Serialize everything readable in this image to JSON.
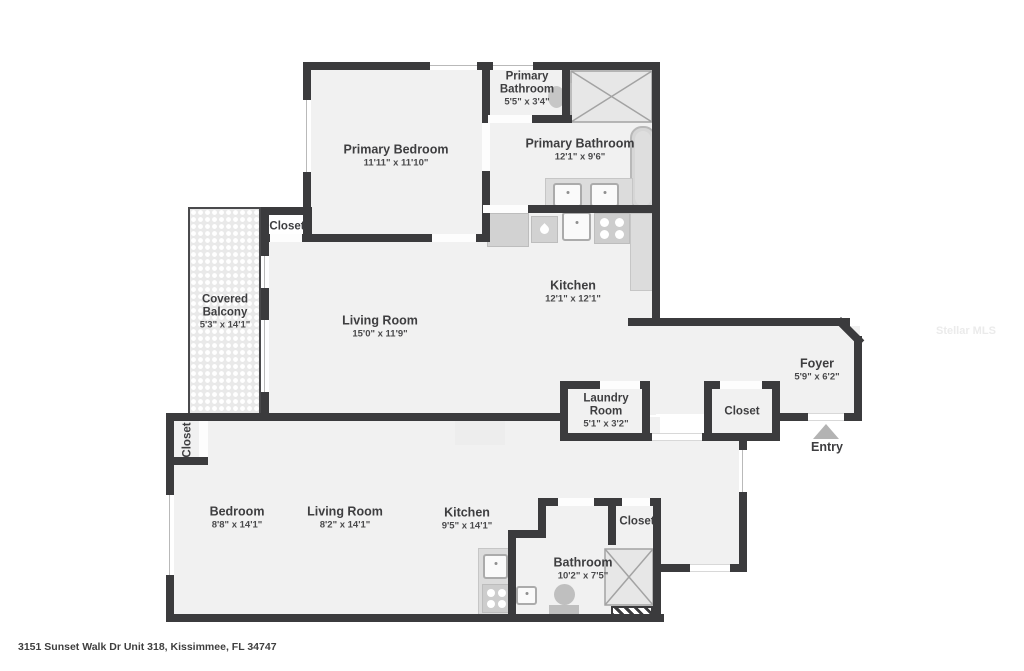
{
  "meta": {
    "address": "3151 Sunset Walk Dr Unit 318, Kissimmee, FL 34747",
    "watermark": "Stellar MLS"
  },
  "colors": {
    "wall": "#3b3b3d",
    "floor": "#f1f1f1",
    "fixture": "#d2d2d2",
    "balcony_tile": "#e9e9e9",
    "entry_arrow": "#b3b3b3",
    "text": "#3e3e40",
    "background": "#ffffff"
  },
  "icons": {
    "entry-arrow-icon": "triangle-up",
    "shower-icon": "x-cross-box",
    "stove-icon": "four-burners",
    "sink-icon": "square-basin",
    "dishwasher-icon": "water-drop",
    "bathtub-icon": "rounded-tub",
    "toilet-icon": "tank-and-bowl"
  },
  "rooms": {
    "primary_bedroom": {
      "name": "Primary Bedroom",
      "dims": "11'11\" x 11'10\""
    },
    "primary_bathroom_small": {
      "name_line1": "Primary",
      "name_line2": "Bathroom",
      "dims": "5'5\" x 3'4\""
    },
    "primary_bathroom": {
      "name": "Primary Bathroom",
      "dims": "12'1\" x 9'6\""
    },
    "closet_upper": {
      "name": "Closet"
    },
    "kitchen_upper": {
      "name": "Kitchen",
      "dims": "12'1\" x 12'1\""
    },
    "covered_balcony": {
      "name_line1": "Covered",
      "name_line2": "Balcony",
      "dims": "5'3\" x 14'1\""
    },
    "living_room_upper": {
      "name": "Living Room",
      "dims": "15'0\" x 11'9\""
    },
    "foyer": {
      "name": "Foyer",
      "dims": "5'9\" x 6'2\""
    },
    "laundry_room": {
      "name_line1": "Laundry",
      "name_line2": "Room",
      "dims": "5'1\" x 3'2\""
    },
    "closet_hall": {
      "name": "Closet"
    },
    "entry": {
      "name": "Entry"
    },
    "closet_lower_left": {
      "name": "Closet"
    },
    "bedroom_lower": {
      "name": "Bedroom",
      "dims": "8'8\" x 14'1\""
    },
    "living_room_lower": {
      "name": "Living Room",
      "dims": "8'2\" x 14'1\""
    },
    "kitchen_lower": {
      "name": "Kitchen",
      "dims": "9'5\" x 14'1\""
    },
    "bathroom_lower": {
      "name": "Bathroom",
      "dims": "10'2\" x 7'5\""
    },
    "closet_lower_right": {
      "name": "Closet"
    }
  }
}
